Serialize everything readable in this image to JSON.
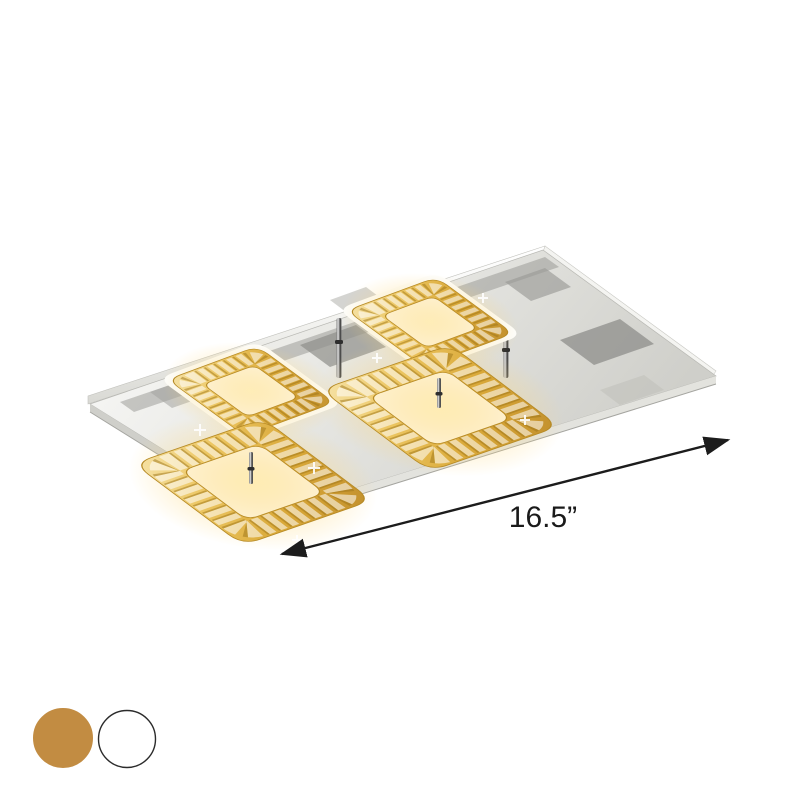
{
  "page": {
    "background": "#ffffff"
  },
  "product": {
    "description": "Rectangular chrome-canopy LED semi-flush ceiling light with four square amber crystal rings",
    "dimension_label": "16.5”",
    "accent_colors": {
      "crystal_amber": "#d9a838",
      "glow": "#ffd87a",
      "canopy_chrome": "#cfcfca",
      "arrow": "#1c1c1c"
    }
  },
  "swatches": {
    "items": [
      {
        "name": "gold",
        "color": "#C28C42",
        "border": "#C28C42"
      },
      {
        "name": "white",
        "color": "#FFFFFF",
        "border": "#2b2b2b"
      }
    ]
  }
}
